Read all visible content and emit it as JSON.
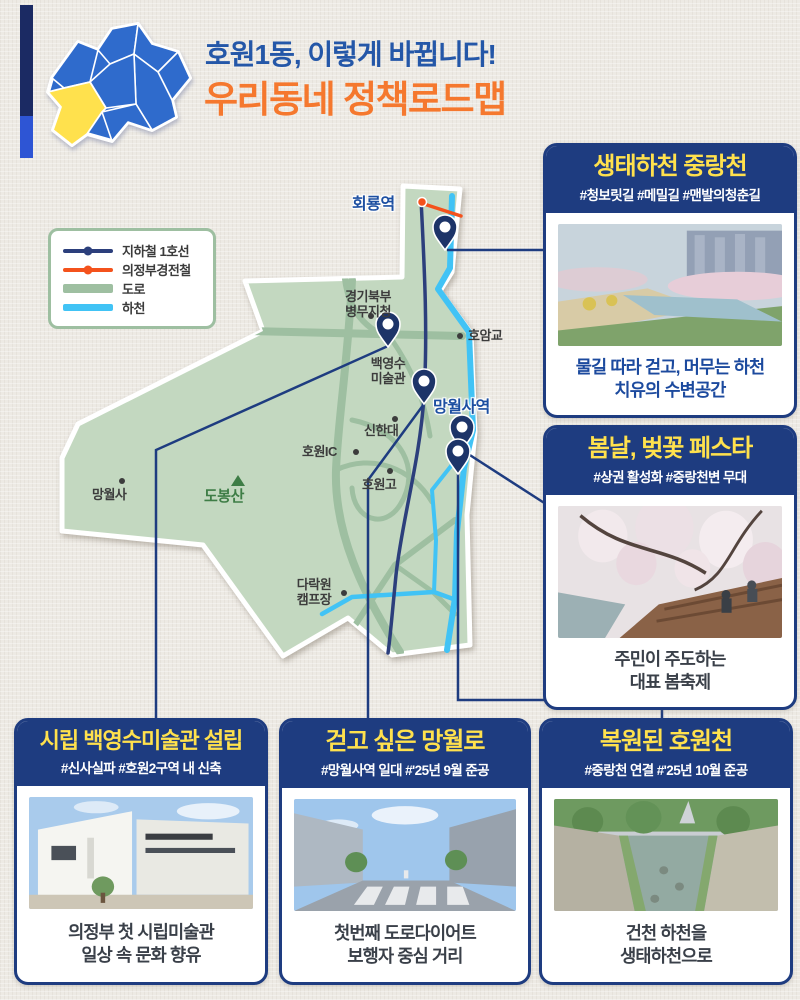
{
  "poster": {
    "title_line1": "호원1동, 이렇게 바뀝니다!",
    "title_line2": "우리동네 정책로드맵",
    "colors": {
      "title_blue": "#2457a8",
      "title_orange": "#f5782e",
      "card_navy": "#1e3c80",
      "card_title_yellow": "#ffe14d",
      "district_fill": "#c3d8c0",
      "road_green": "#9ebfa1",
      "stream_blue": "#41c3f5",
      "subway_navy": "#2c3f7c",
      "lrt_orange": "#f4521c",
      "highlight_yellow": "#ffe14d"
    }
  },
  "legend": {
    "items": [
      {
        "label": "지하철 1호선",
        "color": "#2c3f7c",
        "style": "line-dot"
      },
      {
        "label": "의정부경전철",
        "color": "#f4521c",
        "style": "line-dot"
      },
      {
        "label": "도로",
        "color": "#9ebfa1",
        "style": "band"
      },
      {
        "label": "하천",
        "color": "#41c3f5",
        "style": "band"
      }
    ]
  },
  "map": {
    "stations": {
      "hoeryong": "회룡역",
      "mangwolsa": "망월사역"
    },
    "labels": {
      "gyeonggi_office": "경기북부\n병무지청",
      "hoamgyo": "호암교",
      "baekyeongsu": "백영수\n미술관",
      "shinhan_univ": "신한대",
      "howon_ic": "호원IC",
      "howon_high": "호원고",
      "mangwolsa_temple": "망월사",
      "dobongsan": "도봉산",
      "darakwon_camp": "다락원\n캠프장"
    }
  },
  "cards": {
    "jungnang": {
      "title": "생태하천 중랑천",
      "tags": "#청보릿길 #메밀길 #맨발의청춘길",
      "caption": "물길 따라 걷고, 머무는 하천\n치유의 수변공간"
    },
    "blossom": {
      "title": "봄날, 벚꽃 페스타",
      "tags": "#상권 활성화 #중랑천변 무대",
      "caption": "주민이 주도하는\n대표 봄축제"
    },
    "museum": {
      "title": "시립 백영수미술관 설립",
      "tags": "#신사실파 #호원2구역 내 신축",
      "caption": "의정부 첫 시립미술관\n일상 속 문화 향유"
    },
    "mangwolro": {
      "title": "걷고 싶은 망월로",
      "tags": "#망월사역 일대 #'25년 9월 준공",
      "caption": "첫번째 도로다이어트\n보행자 중심 거리"
    },
    "howoncheon": {
      "title": "복원된 호원천",
      "tags": "#중랑천 연결 #'25년 10월 준공",
      "caption": "건천 하천을\n생태하천으로"
    }
  }
}
